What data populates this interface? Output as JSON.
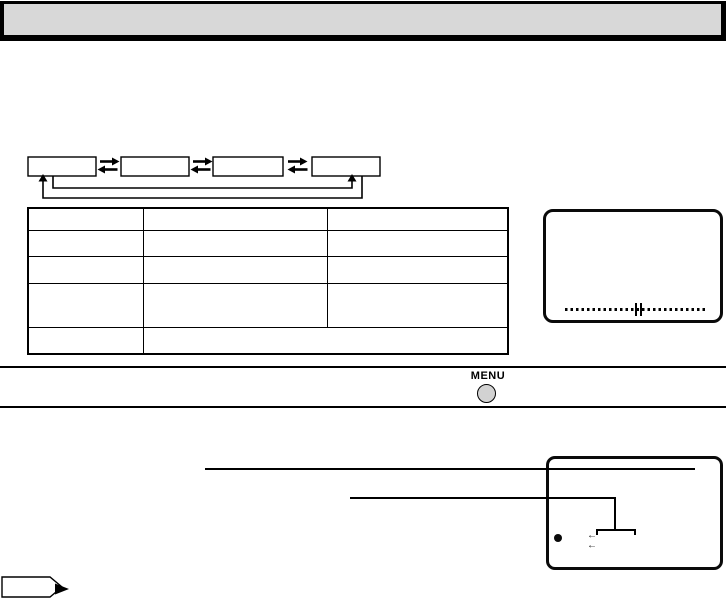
{
  "header": {
    "title": "",
    "fill": "#d8d8d8"
  },
  "flow_diagram": {
    "boxes": [
      {
        "label": ""
      },
      {
        "label": ""
      },
      {
        "label": ""
      },
      {
        "label": ""
      }
    ],
    "link_arrows": "right-left pairs between boxes",
    "wrap_arrows": "box1 to box4 and box4 to box1 return lines"
  },
  "menu_table": {
    "rows": [
      [
        "",
        "",
        ""
      ],
      [
        "",
        "",
        ""
      ],
      [
        "",
        "",
        ""
      ],
      [
        "",
        "",
        ""
      ],
      [
        "",
        ""
      ]
    ]
  },
  "lcd_screen": {
    "scale_center_marker": "||"
  },
  "menu_control": {
    "label": "MENU"
  },
  "osd_callout": {
    "bullet": "●",
    "arrow_1": "←",
    "arrow_2": "←"
  },
  "colors": {
    "header_fill": "#d8d8d8",
    "button_fill": "#d2d2d2",
    "ink": "#000000"
  }
}
